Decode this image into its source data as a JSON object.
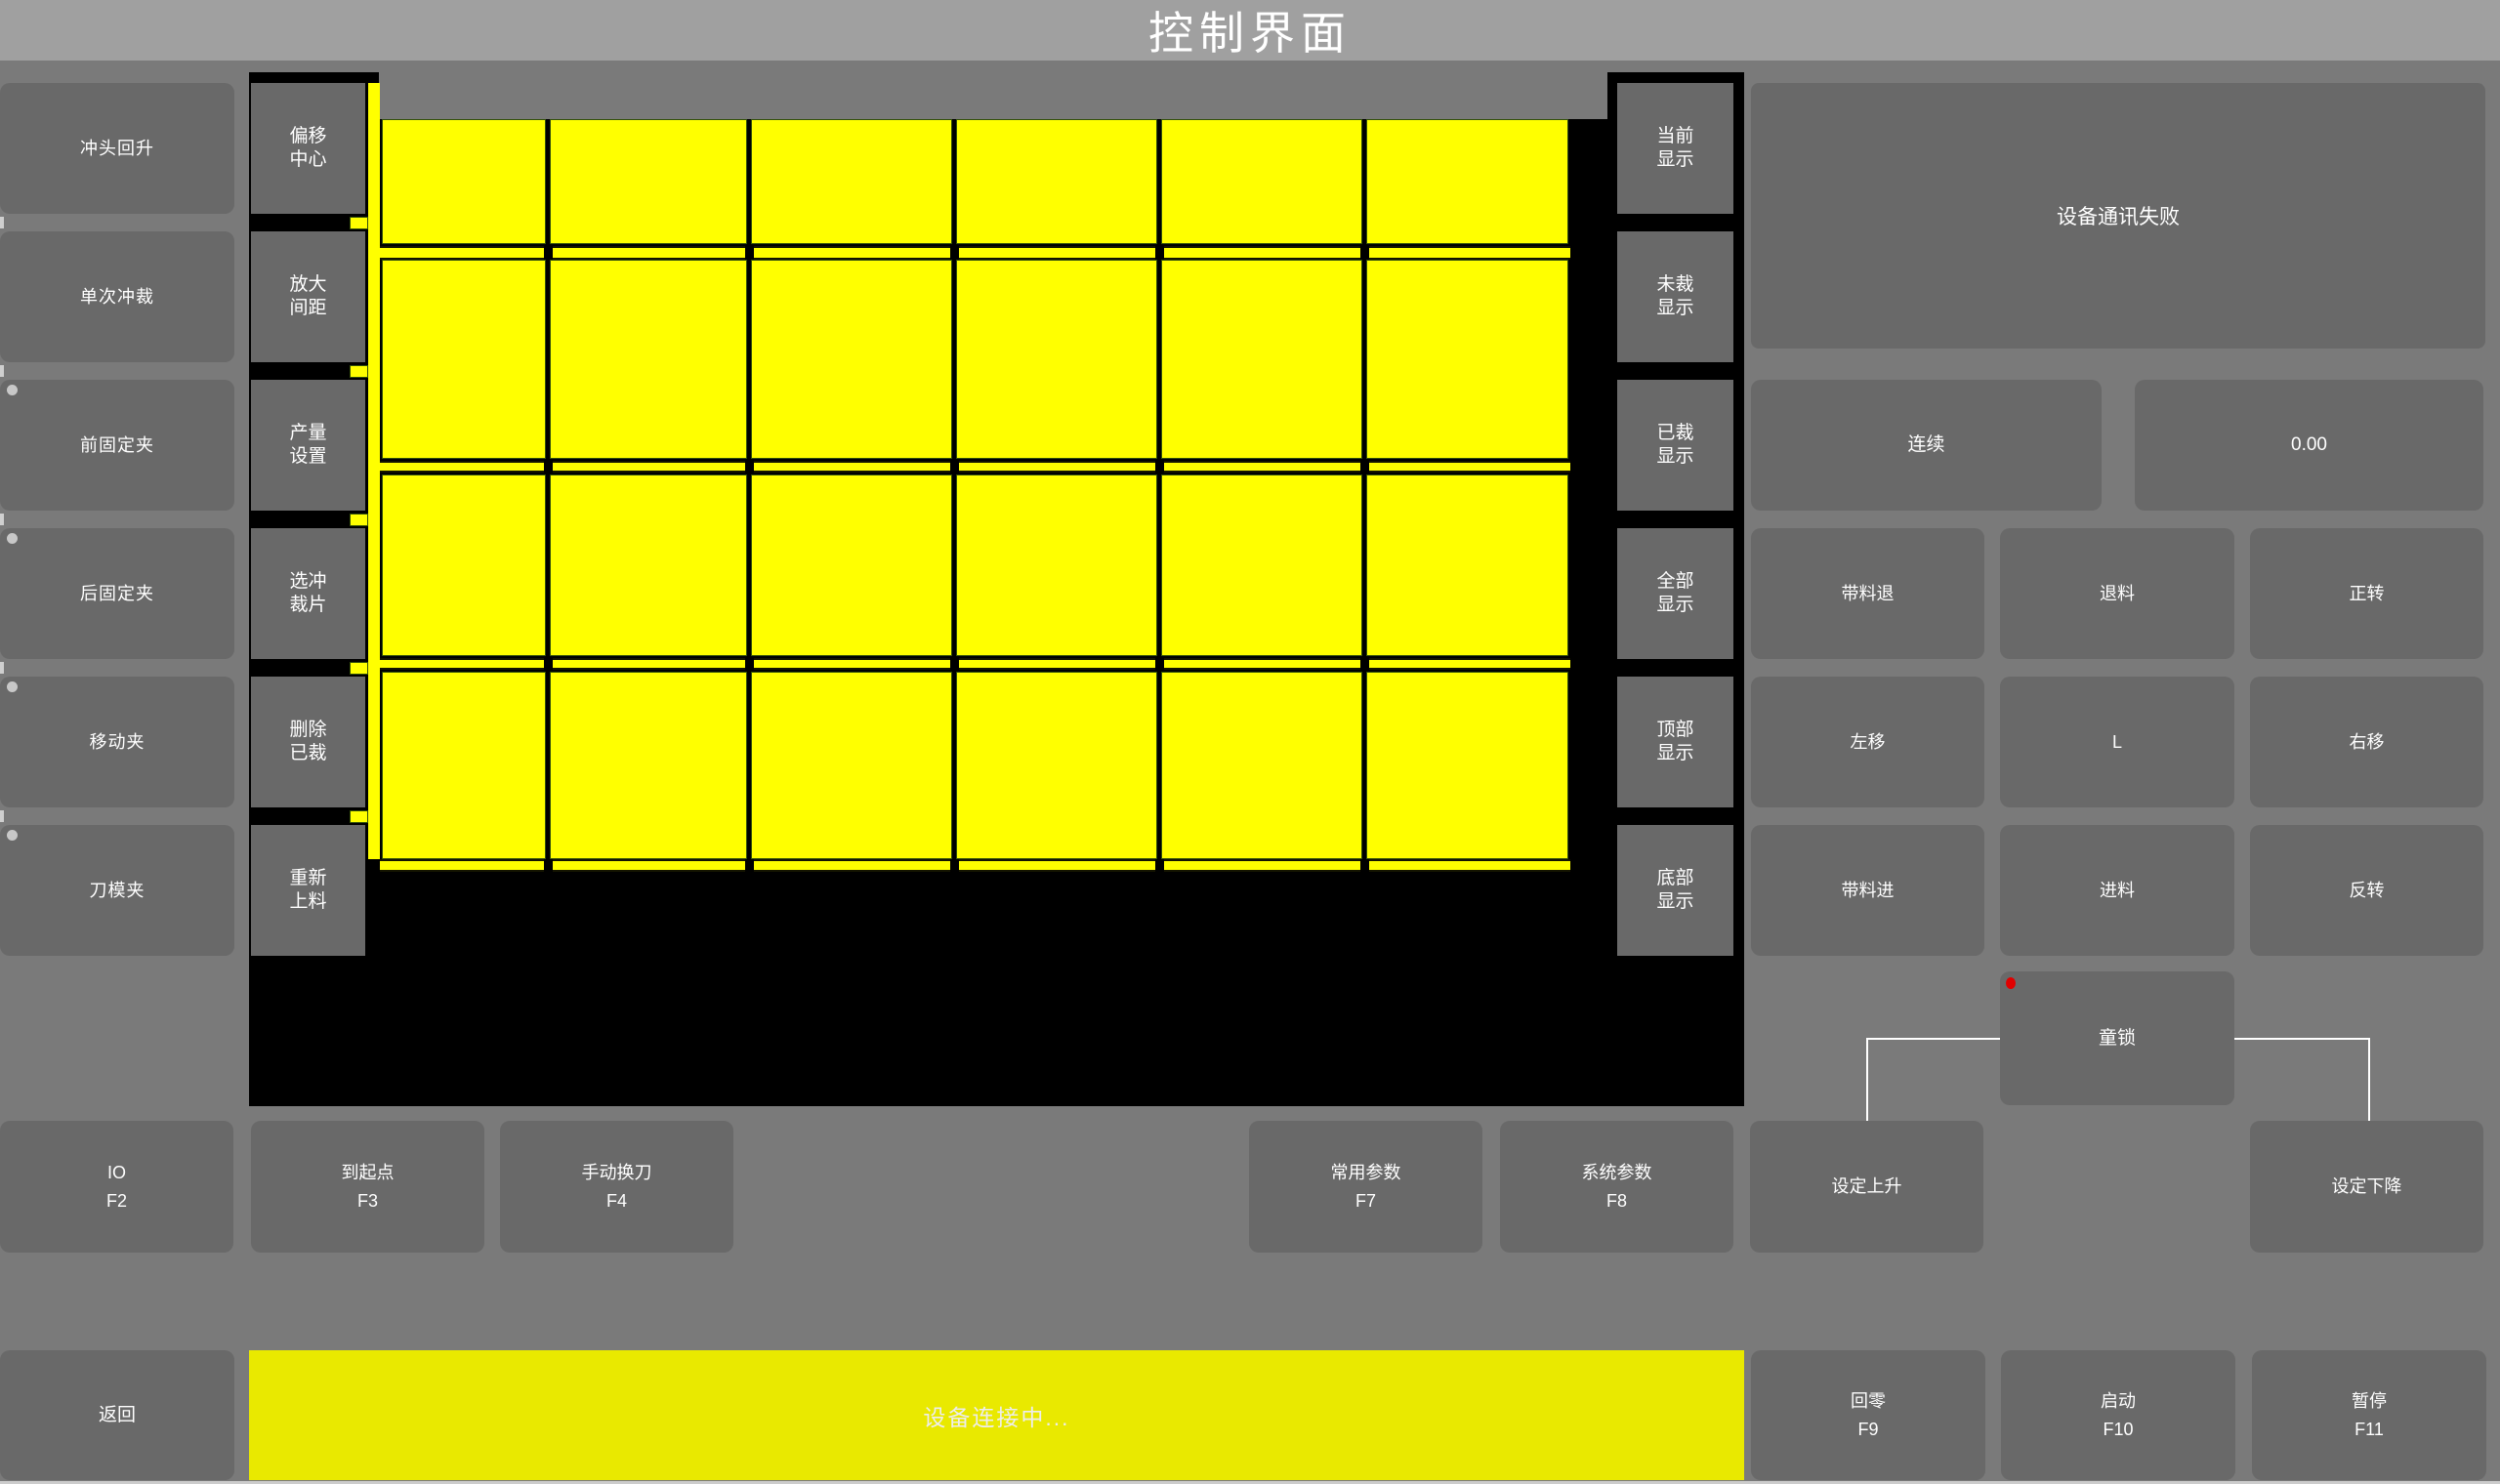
{
  "title": "控制界面",
  "colors": {
    "grid_yellow": "#ffff00",
    "status_bar_yellow": "#e9e900",
    "canvas_black": "#000000",
    "alert_red": "#e00000",
    "button_gray": "#696969"
  },
  "left_panel": {
    "buttons": [
      {
        "label": "冲头回升",
        "indicator": false
      },
      {
        "label": "单次冲裁",
        "indicator": false
      },
      {
        "label": "前固定夹",
        "indicator": true
      },
      {
        "label": "后固定夹",
        "indicator": true
      },
      {
        "label": "移动夹",
        "indicator": true
      },
      {
        "label": "刀模夹",
        "indicator": true
      }
    ]
  },
  "tool_panel": {
    "buttons": [
      "偏移\n中心",
      "放大\n间距",
      "产量\n设置",
      "选冲\n裁片",
      "删除\n已裁",
      "重新\n上料"
    ]
  },
  "display_panel": {
    "buttons": [
      "当前\n显示",
      "未裁\n显示",
      "已裁\n显示",
      "全部\n显示",
      "顶部\n显示",
      "底部\n显示"
    ]
  },
  "right_panel": {
    "message": "设备通讯失败",
    "mode_button": "连续",
    "value_button": "0.00",
    "jog_buttons": [
      [
        "带料退",
        "退料",
        "正转"
      ],
      [
        "左移",
        "L",
        "右移"
      ],
      [
        "带料进",
        "进料",
        "反转"
      ]
    ],
    "child_lock_button": "童锁"
  },
  "function_row": {
    "buttons": [
      {
        "label": "IO",
        "fkey": "F2"
      },
      {
        "label": "到起点",
        "fkey": "F3"
      },
      {
        "label": "手动换刀",
        "fkey": "F4"
      },
      {
        "label": "常用参数",
        "fkey": "F7"
      },
      {
        "label": "系统参数",
        "fkey": "F8"
      },
      {
        "label": "设定上升",
        "fkey": ""
      },
      {
        "label": "设定下降",
        "fkey": ""
      }
    ]
  },
  "bottom_bar": {
    "back_button": "返回",
    "status_message": "设备连接中...",
    "buttons": [
      {
        "label": "回零",
        "fkey": "F9"
      },
      {
        "label": "启动",
        "fkey": "F10"
      },
      {
        "label": "暂停",
        "fkey": "F11"
      }
    ]
  },
  "canvas": {
    "grid_rows": 4,
    "grid_cols": 6
  }
}
